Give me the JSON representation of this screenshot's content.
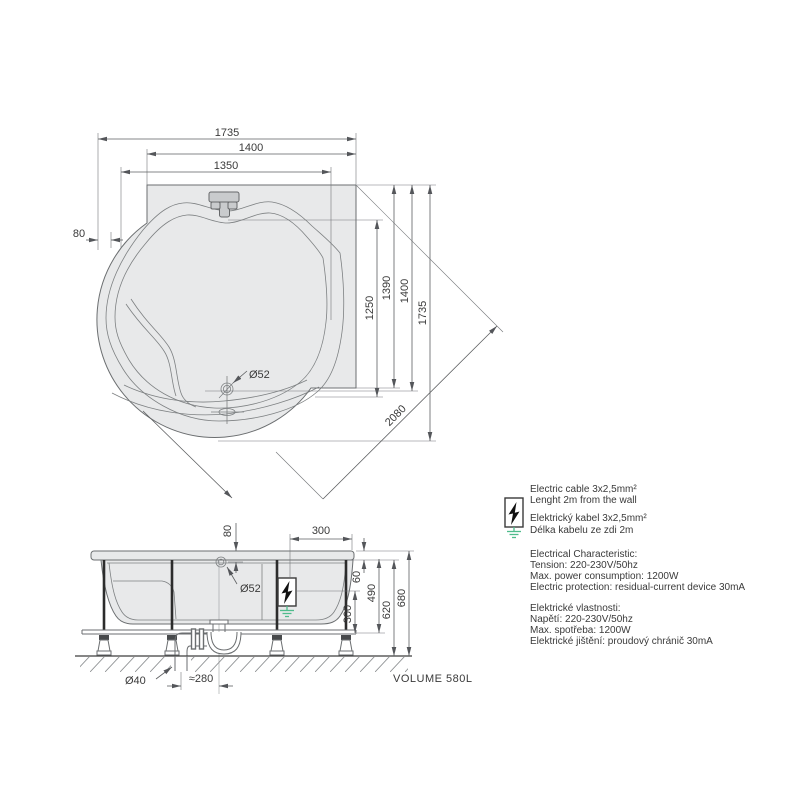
{
  "top_view": {
    "dim_width_outer": "1735",
    "dim_width_wall": "1400",
    "dim_width_inner": "1350",
    "dim_offset_left": "80",
    "dim_depth_basin": "1250",
    "dim_depth_a": "1390",
    "dim_depth_b": "1400",
    "dim_depth_outer": "1735",
    "dim_diagonal": "2080",
    "label_drain": "Ø52"
  },
  "side_view": {
    "dim_drain_from_top": "80",
    "dim_box_from_edge": "300",
    "dim_rim_height": "60",
    "dim_frame_height": "490",
    "dim_body_height": "620",
    "dim_total_height": "680",
    "dim_box_height": "300",
    "label_drain": "Ø52",
    "label_waste_pipe": "Ø40",
    "dim_trap_offset": "≈280",
    "volume_label": "VOLUME 580L"
  },
  "notes": {
    "cable": [
      "Electric cable 3x2,5mm²",
      "Lenght 2m from the wall",
      "Elektrický kabel 3x2,5mm²",
      "Délka kabelu ze zdi 2m"
    ],
    "electrical_en": [
      "Electrical Characteristic:",
      "Tension: 220-230V/50hz",
      "Max. power consumption: 1200W",
      "Electric protection: residual-current device 30mA"
    ],
    "electrical_cz": [
      "Elektrické vlastnosti:",
      "Napětí: 220-230V/50hz",
      "Max. spotřeba: 1200W",
      "Elektrické jištění: proudový chránič 30mA"
    ]
  },
  "colors": {
    "ground_symbol_green": "#4fbc8c",
    "line_gray": "#6b6e70",
    "fill_gray": "#e8e9ea"
  }
}
